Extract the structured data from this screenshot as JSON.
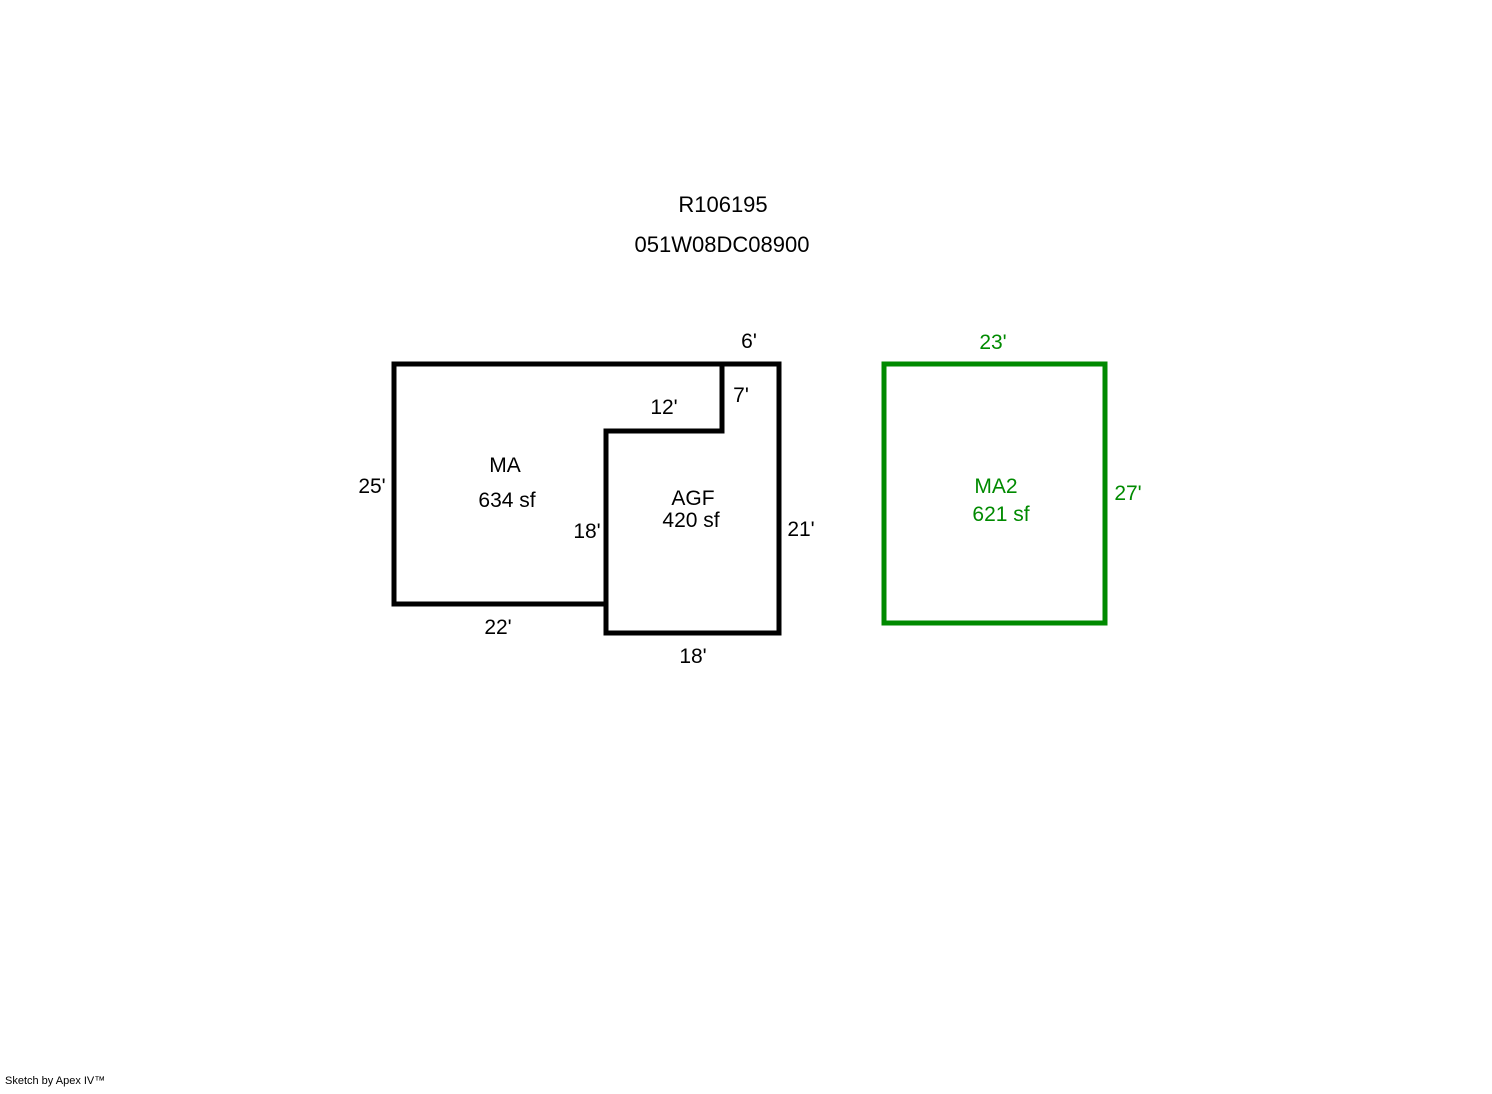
{
  "header": {
    "record_id": "R106195",
    "parcel_id": "051W08DC08900"
  },
  "colors": {
    "black_outline": "#000000",
    "green_outline": "#008A00"
  },
  "sketch": {
    "ma": {
      "label": "MA",
      "area": "634 sf",
      "dims": {
        "left": "25'",
        "bottom": "22'",
        "notch_vertical": "18'",
        "notch_horizontal": "12'"
      }
    },
    "agf": {
      "label": "AGF",
      "area": "420 sf",
      "dims": {
        "top": "6'",
        "right_upper": "7'",
        "right_lower": "21'",
        "bottom": "18'"
      }
    },
    "ma2": {
      "label": "MA2",
      "area": "621 sf",
      "dims": {
        "top": "23'",
        "right": "27'"
      }
    }
  },
  "footer": {
    "credit": "Sketch by Apex IV™"
  }
}
